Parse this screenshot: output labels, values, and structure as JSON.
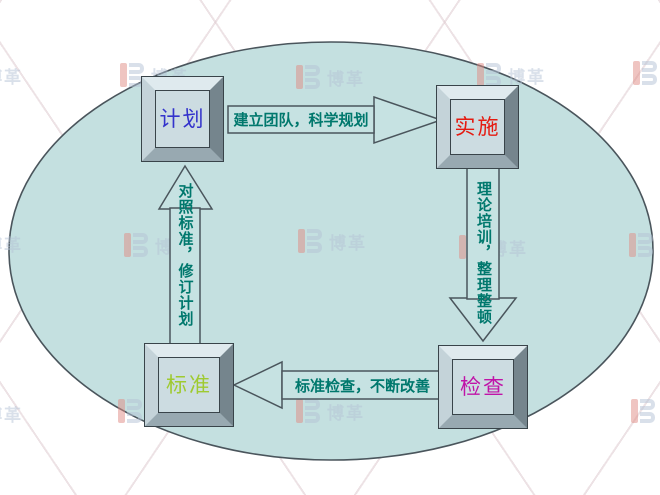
{
  "watermark": {
    "brand": "博革",
    "logo": "boge-b-mark"
  },
  "colors": {
    "ellipse_fill": "#c4e0e0",
    "arrow_fill": "#c6e2e2",
    "outline": "#4a555c",
    "edge_label_color": "#00786d",
    "watermark_blue": "#b5c3d6",
    "watermark_red": "#e08b84"
  },
  "diagram": {
    "type": "pdca-cycle",
    "nodes": [
      {
        "id": "plan",
        "label": "计划",
        "color": "#3333cc"
      },
      {
        "id": "do",
        "label": "实施",
        "color": "#e51a10"
      },
      {
        "id": "check",
        "label": "检查",
        "color": "#c013a8"
      },
      {
        "id": "standard",
        "label": "标准",
        "color": "#9fca30"
      }
    ],
    "edges": [
      {
        "from": "计划",
        "to": "实施",
        "direction": "right",
        "label": "建立团队，科学规划"
      },
      {
        "from": "实施",
        "to": "检查",
        "direction": "down",
        "label": "理论培训，整理整顿"
      },
      {
        "from": "检查",
        "to": "标准",
        "direction": "left",
        "label": "标准检查，不断改善"
      },
      {
        "from": "标准",
        "to": "计划",
        "direction": "up",
        "label": "对照标准，修订计划"
      }
    ]
  }
}
